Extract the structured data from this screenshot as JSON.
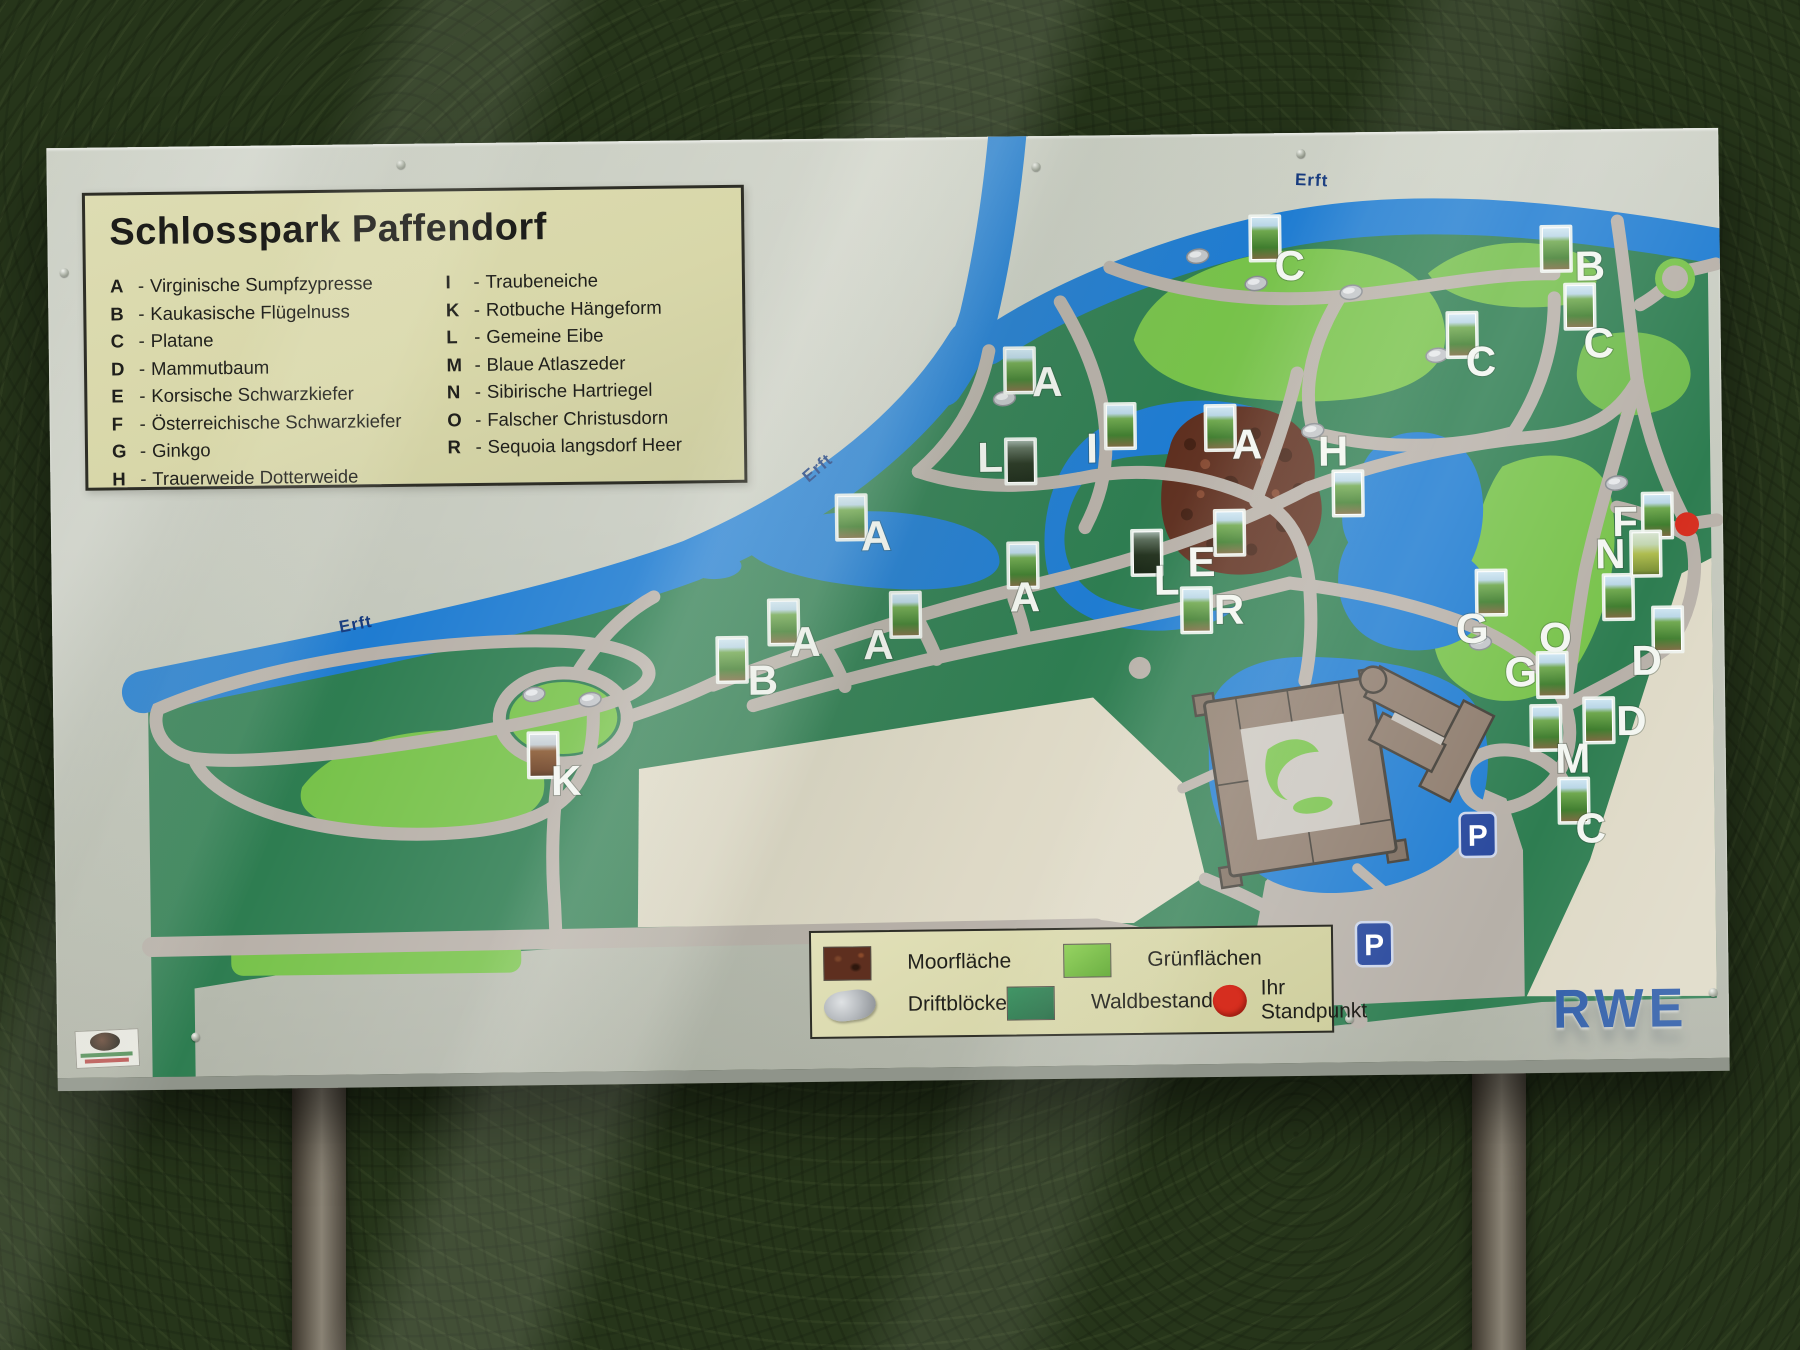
{
  "sign": {
    "title": "Schlosspark Paffendorf",
    "species_left": [
      {
        "key": "A",
        "name": "Virginische Sumpfzypresse"
      },
      {
        "key": "B",
        "name": "Kaukasische Flügelnuss"
      },
      {
        "key": "C",
        "name": "Platane"
      },
      {
        "key": "D",
        "name": "Mammutbaum"
      },
      {
        "key": "E",
        "name": "Korsische Schwarzkiefer"
      },
      {
        "key": "F",
        "name": "Österreichische Schwarzkiefer"
      },
      {
        "key": "G",
        "name": "Ginkgo"
      },
      {
        "key": "H",
        "name": "Trauerweide Dotterweide"
      }
    ],
    "species_right": [
      {
        "key": "I",
        "name": "Traubeneiche"
      },
      {
        "key": "K",
        "name": "Rotbuche Hängeform"
      },
      {
        "key": "L",
        "name": "Gemeine Eibe"
      },
      {
        "key": "M",
        "name": "Blaue Atlaszeder"
      },
      {
        "key": "N",
        "name": "Sibirische Hartriegel"
      },
      {
        "key": "O",
        "name": "Falscher Christusdorn"
      },
      {
        "key": "R",
        "name": "Sequoia langsdorf Heer"
      }
    ],
    "river_label": "Erft",
    "parking_label": "P",
    "brand": "RWE",
    "map_legend": {
      "moor": "Moorfläche",
      "lawn": "Grünflächen",
      "drift": "Driftblöcke",
      "forest": "Waldbestand",
      "standpoint": "Ihr Standpunkt"
    },
    "markers": [
      {
        "letter": "C",
        "lx": 1242,
        "ly": 132,
        "tx": 1204,
        "ty": 84,
        "v": "g"
      },
      {
        "letter": "B",
        "lx": 1542,
        "ly": 136,
        "tx": 1495,
        "ty": 98,
        "v": "g"
      },
      {
        "letter": "C",
        "lx": 1432,
        "ly": 230,
        "tx": 1400,
        "ty": 183,
        "v": "g"
      },
      {
        "letter": "C",
        "lx": 1550,
        "ly": 213,
        "tx": 1518,
        "ty": 156,
        "v": "g"
      },
      {
        "letter": "A",
        "lx": 998,
        "ly": 245,
        "tx": 957,
        "ty": 213,
        "v": "g"
      },
      {
        "letter": "I",
        "lx": 1042,
        "ly": 312,
        "tx": 1057,
        "ty": 270,
        "v": "g"
      },
      {
        "letter": "A",
        "lx": 1197,
        "ly": 310,
        "tx": 1157,
        "ty": 273,
        "v": "g"
      },
      {
        "letter": "H",
        "lx": 1283,
        "ly": 318,
        "tx": 1284,
        "ty": 340,
        "v": "g"
      },
      {
        "letter": "L",
        "lx": 940,
        "ly": 320,
        "tx": 957,
        "ty": 304,
        "v": "d"
      },
      {
        "letter": "A",
        "lx": 825,
        "ly": 397,
        "tx": 787,
        "ty": 358,
        "v": "g"
      },
      {
        "letter": "E",
        "lx": 1150,
        "ly": 427,
        "tx": 1165,
        "ty": 378,
        "v": "g"
      },
      {
        "letter": "L",
        "lx": 1115,
        "ly": 445,
        "tx": 1082,
        "ty": 397,
        "v": "d"
      },
      {
        "letter": "R",
        "lx": 1177,
        "ly": 475,
        "tx": 1131,
        "ty": 455,
        "v": "g"
      },
      {
        "letter": "A",
        "lx": 973,
        "ly": 460,
        "tx": 958,
        "ty": 408,
        "v": "g"
      },
      {
        "letter": "A",
        "lx": 753,
        "ly": 502,
        "tx": 718,
        "ty": 462,
        "v": "g"
      },
      {
        "letter": "A",
        "lx": 826,
        "ly": 506,
        "tx": 840,
        "ty": 456,
        "v": "g"
      },
      {
        "letter": "B",
        "lx": 710,
        "ly": 540,
        "tx": 666,
        "ty": 499,
        "v": "g"
      },
      {
        "letter": "K",
        "lx": 512,
        "ly": 638,
        "tx": 476,
        "ty": 592,
        "v": "b"
      },
      {
        "letter": "G",
        "lx": 1420,
        "ly": 497,
        "tx": 1426,
        "ty": 441,
        "v": "g"
      },
      {
        "letter": "O",
        "lx": 1503,
        "ly": 507,
        "tx": 1553,
        "ty": 447,
        "v": "g"
      },
      {
        "letter": "G",
        "lx": 1468,
        "ly": 541,
        "tx": 1486,
        "ty": 524,
        "v": "g"
      },
      {
        "letter": "M",
        "lx": 1519,
        "ly": 628,
        "tx": 1479,
        "ty": 577,
        "v": "g"
      },
      {
        "letter": "C",
        "lx": 1536,
        "ly": 698,
        "tx": 1506,
        "ty": 650,
        "v": "g"
      },
      {
        "letter": "D",
        "lx": 1594,
        "ly": 531,
        "tx": 1602,
        "ty": 480,
        "v": "g"
      },
      {
        "letter": "D",
        "lx": 1578,
        "ly": 591,
        "tx": 1532,
        "ty": 570,
        "v": "g"
      },
      {
        "letter": "F",
        "lx": 1574,
        "ly": 392,
        "tx": 1593,
        "ty": 366,
        "v": "g"
      },
      {
        "letter": "N",
        "lx": 1559,
        "ly": 424,
        "tx": 1581,
        "ty": 404,
        "v": "y"
      }
    ],
    "rocks": [
      [
        1150,
        122
      ],
      [
        1303,
        160
      ],
      [
        1388,
        224
      ],
      [
        955,
        262
      ],
      [
        1263,
        298
      ],
      [
        481,
        552
      ],
      [
        537,
        558
      ],
      [
        1566,
        354
      ],
      [
        1428,
        512
      ],
      [
        1208,
        150
      ]
    ],
    "colors": {
      "water": "#1f7cd1",
      "forest": "#2e7d51",
      "lawn": "#77c24a",
      "path": "#b7b0a8",
      "moor": "#5e2f1f",
      "metal": "#c7cbc0",
      "panel": "#d8d7a9",
      "parking": "#27479c",
      "brand": "#2b5aa7",
      "standpoint": "#d62e1f"
    }
  }
}
